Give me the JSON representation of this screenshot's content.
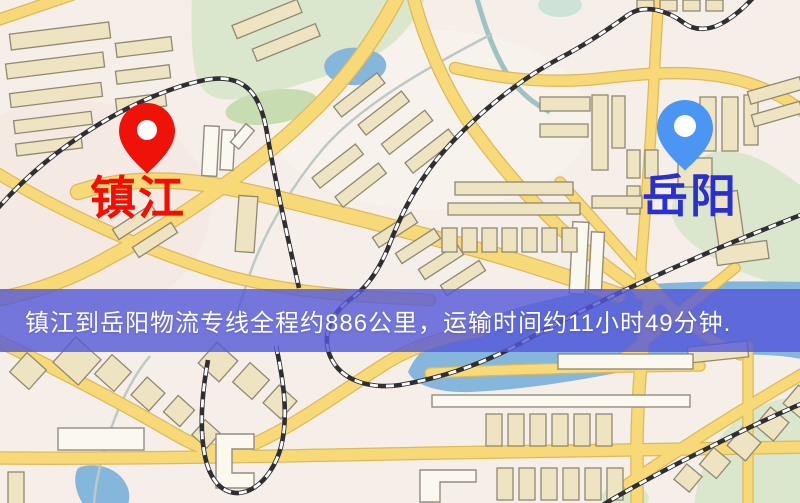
{
  "banner": {
    "text": "镇江到岳阳物流专线全程约886公里，运输时间约11小时49分钟.",
    "bg_color": "rgba(84,88,216,0.8)",
    "text_color": "#ffffff"
  },
  "route": {
    "origin": "镇江",
    "destination": "岳阳",
    "distance_text": "约886公里",
    "duration_text": "约11小时49分钟"
  },
  "markers": {
    "origin": {
      "label": "镇江",
      "icon": "red-location-pin",
      "pin_color": "#ee1208",
      "label_color": "#f50d00"
    },
    "destination": {
      "label": "岳阳",
      "icon": "blue-location-pin",
      "pin_color": "#4b96f3",
      "label_color": "#2a2fd0"
    }
  },
  "map_palette": {
    "background": "#f6efe9",
    "road": "#f7d978",
    "road_casing": "#ddb95c",
    "park": "#dbe7cc",
    "water": "#85b6dc",
    "building": "#efe4c2",
    "railway_dark": "#2f2f33"
  }
}
